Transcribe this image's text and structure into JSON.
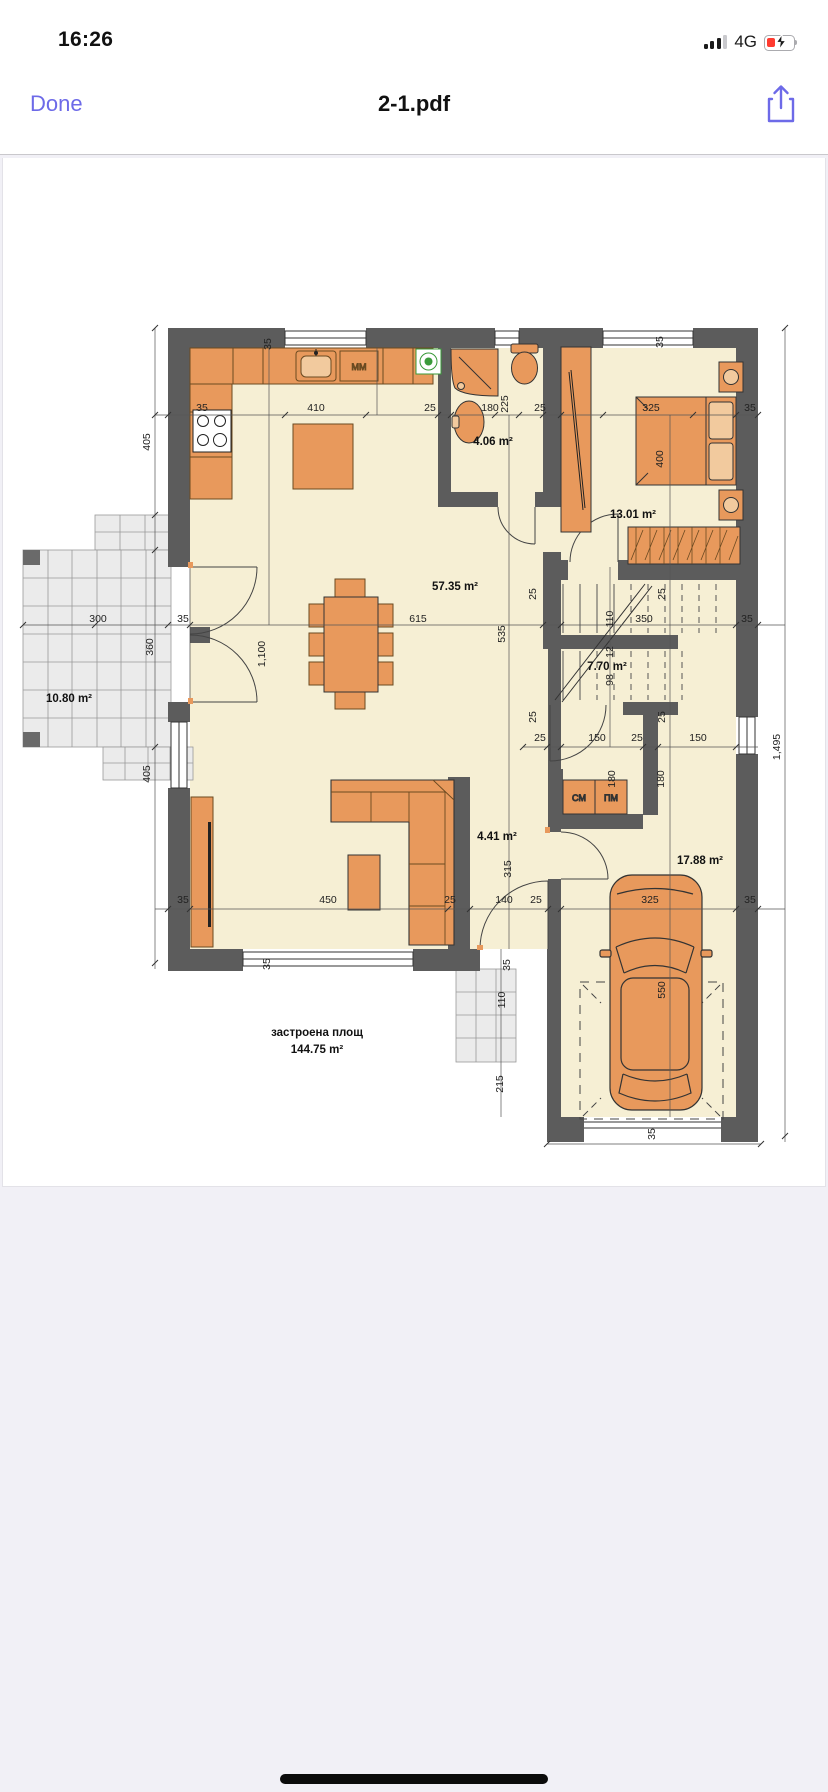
{
  "status_bar": {
    "time": "16:26",
    "network_type": "4G",
    "signal_bars_filled": 3,
    "battery_charging": true
  },
  "nav_bar": {
    "done_label": "Done",
    "title": "2-1.pdf"
  },
  "colors": {
    "accent": "#6D6AE8",
    "wall": "#5C5C5C",
    "floor": "#F6EFD4",
    "furniture": "#E8995C",
    "furniture_light": "#F2CA9E",
    "terrace_tile": "#EBEBEB",
    "battery_low": "#FF3B30",
    "appliance_green": "#3A9A3A"
  },
  "floor_plan": {
    "rooms": {
      "terrace": "10.80 m²",
      "living_dining": "57.35 m²",
      "bathroom": "4.06 m²",
      "bedroom": "13.01 m²",
      "staircase": "7.70 m²",
      "corridor": "4.41 m²",
      "garage": "17.88 m²"
    },
    "total_area": {
      "line1": "застроена площ",
      "line2": "144.75 m²"
    },
    "appliances": {
      "kitchen_mm": "ММ",
      "closet_cm": "СМ",
      "closet_pm": "ПМ"
    },
    "dims": {
      "35": "35",
      "25": "25",
      "410": "410",
      "180": "180",
      "225": "225",
      "325": "325",
      "400": "400",
      "405": "405",
      "300": "300",
      "360": "360",
      "1100": "1,100",
      "615": "615",
      "535": "535",
      "350": "350",
      "110": "110",
      "12": "12",
      "98": "98",
      "150": "150",
      "315": "315",
      "140": "140",
      "450": "450",
      "550": "550",
      "215": "215",
      "1495": "1,495"
    }
  }
}
